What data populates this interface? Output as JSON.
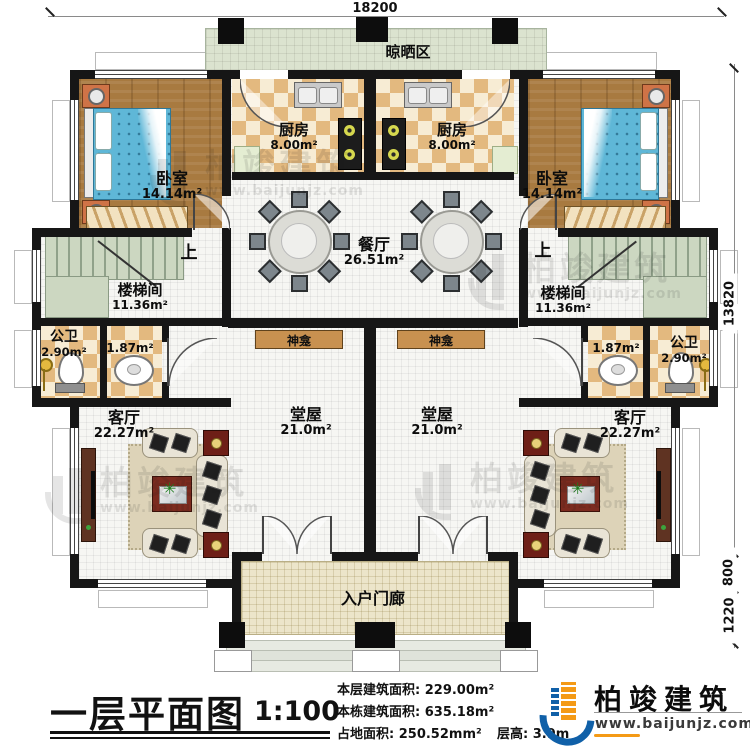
{
  "dimensions": {
    "top": "18200",
    "right_upper": "13820",
    "right_mid": "800",
    "right_lower": "1220"
  },
  "rooms": {
    "drying": {
      "name": "晾晒区"
    },
    "kitchen": {
      "name": "厨房",
      "area": "8.00m²"
    },
    "bedroom": {
      "name": "卧室",
      "area": "14.14m²"
    },
    "dining": {
      "name": "餐厅",
      "area": "26.51m²"
    },
    "stair": {
      "name": "楼梯间",
      "area": "11.36m²",
      "up": "上"
    },
    "bath": {
      "name": "公卫",
      "area": "2.90m²",
      "area_small": "1.87m²"
    },
    "shrine": {
      "name": "神龛"
    },
    "hall": {
      "name": "堂屋",
      "area": "21.0m²"
    },
    "living": {
      "name": "客厅",
      "area": "22.27m²"
    },
    "porch": {
      "name": "入户门廊"
    }
  },
  "title_block": {
    "title": "一层平面图",
    "scale": "1:100",
    "info": [
      {
        "label": "本层建筑面积:",
        "value": "229.00m²"
      },
      {
        "label": "本栋建筑面积:",
        "value": "635.18m²"
      },
      {
        "label": "占地面积:",
        "value": "250.52mm²"
      }
    ],
    "floor_height_label": "层高:",
    "floor_height_value": "3.9m"
  },
  "logo": {
    "name": "柏竣建筑",
    "website": "www.baijunjz.com"
  },
  "watermark": {
    "text": "柏竣建筑",
    "sub": "www.baijunjz.com"
  },
  "colors": {
    "accent_blue": "#1060a8",
    "accent_orange": "#f49a16",
    "wall": "#161616"
  }
}
